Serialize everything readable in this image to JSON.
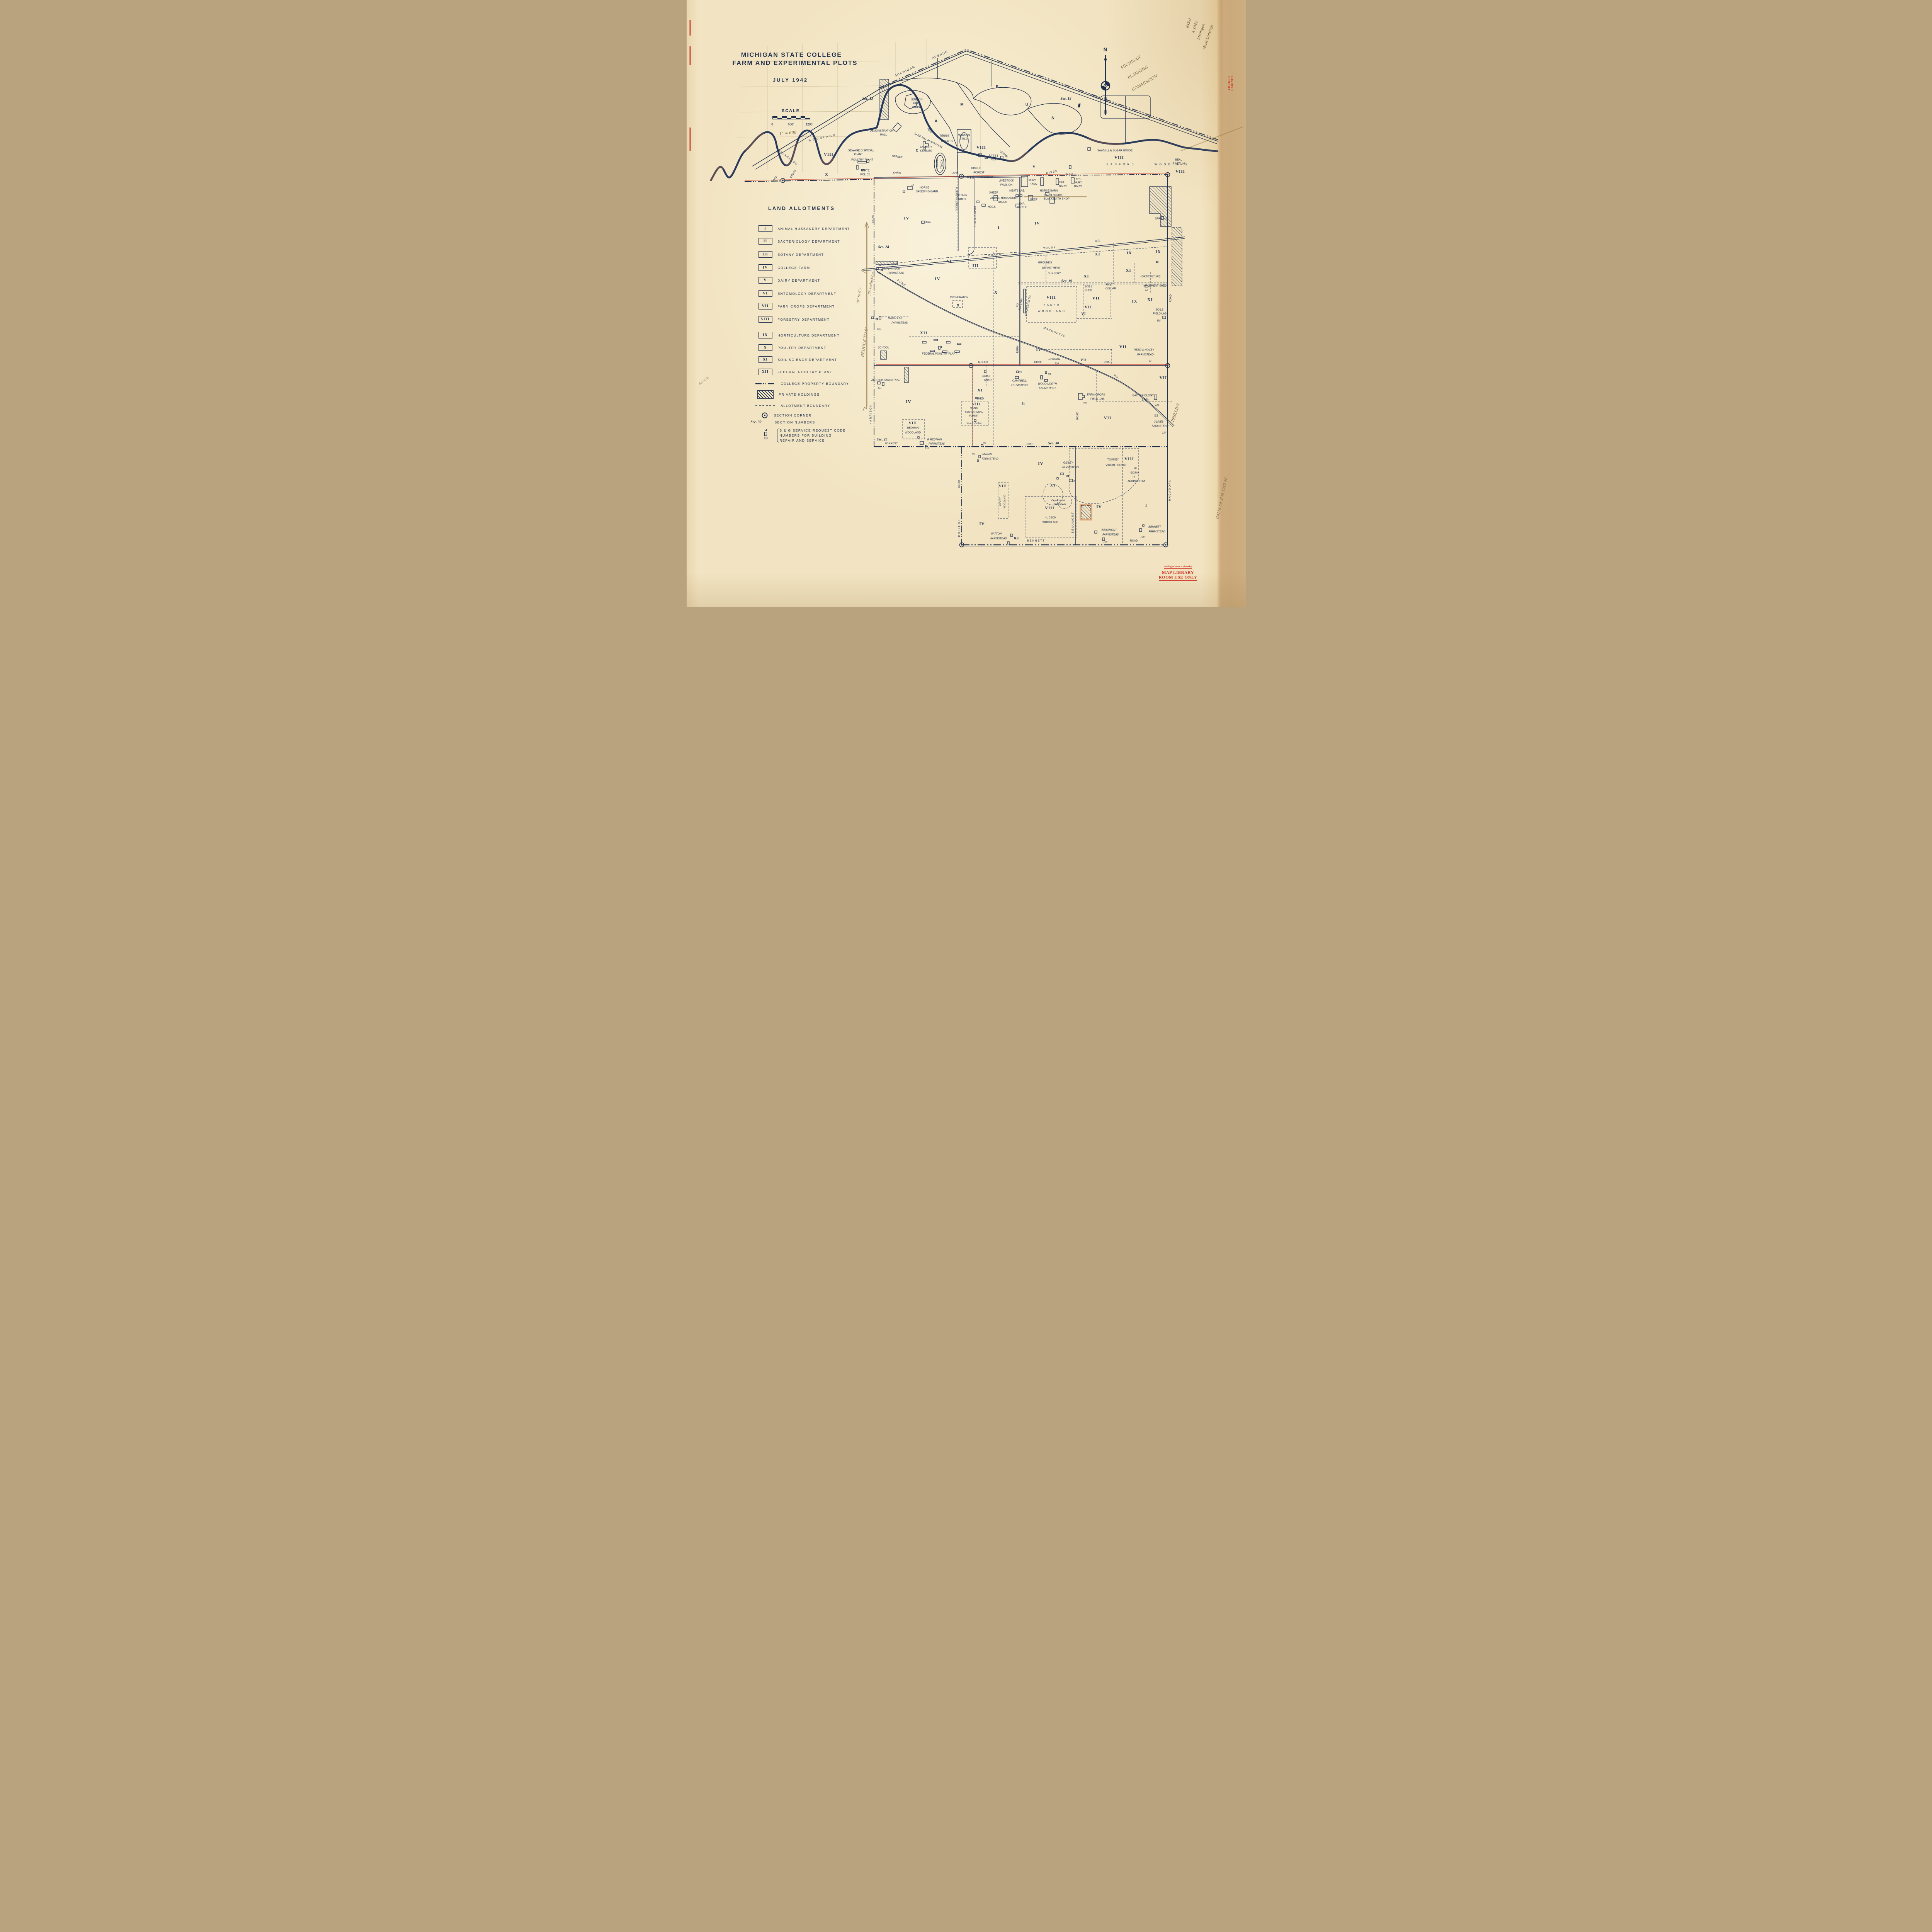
{
  "title": {
    "line1": "MICHIGAN STATE COLLEGE",
    "line2": "FARM AND EXPERIMENTAL PLOTS",
    "line3": "JULY 1942"
  },
  "scale": {
    "heading": "SCALE",
    "t0": "0",
    "t600": "600'",
    "t1200": "1200'",
    "note": "1\" = 600"
  },
  "compass": {
    "n": "N"
  },
  "legend": {
    "heading": "LAND ALLOTMENTS",
    "items": [
      {
        "sym": "I",
        "label": "ANIMAL HUSBANDRY DEPARTMENT"
      },
      {
        "sym": "II",
        "label": "BACTERIOLOGY DEPARTMENT"
      },
      {
        "sym": "III",
        "label": "BOTANY DEPARTMENT"
      },
      {
        "sym": "IV",
        "label": "COLLEGE FARM"
      },
      {
        "sym": "V",
        "label": "DAIRY DEPARTMENT"
      },
      {
        "sym": "VI",
        "label": "ENTOMOLOGY DEPARTMENT"
      },
      {
        "sym": "VII",
        "label": "FARM CROPS DEPARTMENT"
      },
      {
        "sym": "VIII",
        "label": "FORESTRY DEPARTMENT"
      },
      {
        "sym": "IX",
        "label": "HORTICULTURE DEPARTMENT"
      },
      {
        "sym": "X",
        "label": "POULTRY DEPARTMENT"
      },
      {
        "sym": "XI",
        "label": "SOIL SCIENCE DEPARTMENT"
      },
      {
        "sym": "XII",
        "label": "FEDERAL POULTRY PLANT"
      }
    ],
    "extras": {
      "property": "COLLEGE PROPERTY BOUNDARY",
      "private": "PRIVATE HOLDINGS",
      "allotment": "ALLOTMENT BOUNDARY",
      "corner": "SECTION CORNER",
      "secnum_sym": "Sec. 30",
      "secnum": "SECTION NUMBERS",
      "bg1": "B & G SERVICE REQUEST CODE",
      "bg2": "NUMBERS FOR BUILDING",
      "bg3": "REPAIR AND SERVICE",
      "bg_num": "128"
    }
  },
  "num": {
    "I": "I",
    "II": "II",
    "III": "III",
    "IV": "IV",
    "V": "V",
    "VI": "VI",
    "VII": "VII",
    "VIII": "VIII",
    "IX": "IX",
    "X": "X",
    "XI": "XI",
    "XII": "XII"
  },
  "sections": {
    "s13": "Sec. 13",
    "s18": "Sec. 18",
    "s19": "Sec. 19",
    "s24": "Sec. 24",
    "s25": "Sec. 25",
    "s30": "Sec. 30"
  },
  "roads": {
    "michigan": "MICHIGAN",
    "avenue": "AVENUE",
    "us16": "U.S. 16",
    "street": "STREET",
    "kalamazoo": "KALAMAZOO",
    "shaw": "SHAW",
    "lane": "LANE",
    "harrison": "HARRISON",
    "road": "ROAD",
    "college": "COLLEGE",
    "farm": "FARM",
    "mount": "MOUNT",
    "hope": "HOPE",
    "forrest": "FORREST",
    "bennett": "BENNETT",
    "beaumont": "BEAUMONT",
    "hagadorn": "HAGADORN",
    "grand": "GRAND",
    "trunk": "TRUNK",
    "rr": "R.R.",
    "pere": "PERE",
    "marquette": "MARQUETTE",
    "spur": "P. M. R.R. SPUR"
  },
  "map": {
    "campus": [
      "C",
      "A",
      "M",
      "P",
      "U",
      "S"
    ],
    "red": "RED",
    "cedar": "CEDAR",
    "river": "RIVER",
    "woodland": "WOODLAND",
    "jenison": "JENISON",
    "field": "FIELD",
    "house": "HOUSE",
    "demonstration": "DEMONSTRATION",
    "hall": "HALL",
    "sandhill": "SAND HILL PLANTATION",
    "tennis": "TENNIS",
    "courts": "COURTS",
    "macklin": "MACKLIN",
    "cavalry": "CAVALRY",
    "stables": "STABLES",
    "running": "RUNNING",
    "track": "TRACK",
    "sewage": "SEWAGE DISPOSAL",
    "plant": "PLANT",
    "poultryplant": "POULTRY PLANT",
    "state": "STATE",
    "police": "POLICE",
    "horse": "HORSE",
    "breedingbarn": "BREEDING BARN",
    "n70": "70",
    "forestnursery": "FOREST NURSERY",
    "botany": "BOTANY",
    "shed": "SHED",
    "bogue": "BOGUE",
    "forest": "FOREST",
    "nursery": "NURSERY",
    "livestock": "LIVESTOCK",
    "pavilion": "PAVILION",
    "sheep": "SHEEP",
    "meatslab": "MEATS LAB.",
    "animalhusbandry": "ANIMAL HUSBANDRY",
    "barns": "BARNS",
    "beef": "BEEF",
    "exp": "EXP.",
    "cattle": "CATTLE",
    "hogs": "HOGS",
    "dairy": "DAIRY",
    "barn": "BARN",
    "bull": "BULL",
    "expl": "EXP'L.",
    "horsebarn": "HORSE BARN",
    "farmoffice": "FARM OFFICE",
    "blacksmith": "BLACKSMITH SHOP",
    "wkar": "W K A R",
    "sanford": "SANFORD",
    "sawmill": "SAWMILL & SUGAR HOUSE",
    "beal": "BEAL",
    "pinetum": "PINETUM",
    "n119": "119",
    "grounds": "GROUNDS",
    "department": "DEPARTMENT",
    "soils": "SOILS",
    "root": "ROOT",
    "cellar": "CELLAR",
    "horticulture": "HORTICULTURE",
    "implementshed": "IMPLEMENT SHED",
    "n14": "14",
    "fieldlab": "FIELD LAB.",
    "n118": "118",
    "incinerator": "INCINERATOR",
    "n122": "122",
    "poultry": "POULTRY",
    "contestbldg": "CONTEST BLDG.",
    "baker": "BAKER",
    "hutchinson": "HUTCHINSON",
    "farmstead": "FARMSTEAD",
    "n95": "95",
    "macallan": "MACALLAN",
    "n126": "126",
    "federalpoultry": "FEDERAL POULTRY PLANT",
    "school": "SCHOOL",
    "aldrich": "ALDRICH FARMSTEAD",
    "n131": "131",
    "redman": "REDMAN",
    "n120": "120",
    "reedhovey": "REED & HOVEY",
    "n97": "97",
    "campbell": "CAMPBELL",
    "n93": "93",
    "woodworth": "WOODWORTH",
    "n94": "94",
    "farmcrops": "FARM CROPS",
    "n108": "108",
    "bacteriology": "BACTERIOLOGY",
    "n121": "121",
    "minnis": "MINNIS",
    "recreational": "RECREATIONAL",
    "waacabin": "W.A.A. CABIN",
    "fredman": "F. REDMAN",
    "n133": "133",
    "n99": "99",
    "glines": "GLINES",
    "n127": "127",
    "toumey": "TOUMEY",
    "virginforest": "VIRGIN FOREST",
    "sigma": "SIGMA",
    "pi": "PI",
    "arboretum": "ARBORETUM",
    "gidley": "GIDLEY",
    "experimental": "Experimental",
    "watersheds": "Watersheds",
    "hudson": "HUDSON",
    "patton": "PATTON",
    "n130": "130",
    "n129": "129",
    "n128": "128",
    "beaumontf": "BEAUMONT",
    "bennettf": "BENNETT"
  },
  "annotations": {
    "planning1": "MICHIGAN",
    "planning2": "PLANNING",
    "planning3": "COMMISSION",
    "cat1": "843-d",
    "cat2": "A-1942",
    "cat3": "Michigan",
    "cat4": "(East Lansing)",
    "reduce1": "REDUCE TO 6\"",
    "reduce2": "(8\" to 6\")",
    "reduce3": ".75 reduction",
    "phillips": "PHILLIPS",
    "callno": "G4114.E4:2M4 1942 M5",
    "marginnote": "8:1:6:X:"
  },
  "stamps": {
    "locked": "LOCKED CABINET",
    "lib1": "Michigan State University",
    "lib2": "MAP LIBRARY",
    "lib3": "ROOM USE ONLY"
  }
}
